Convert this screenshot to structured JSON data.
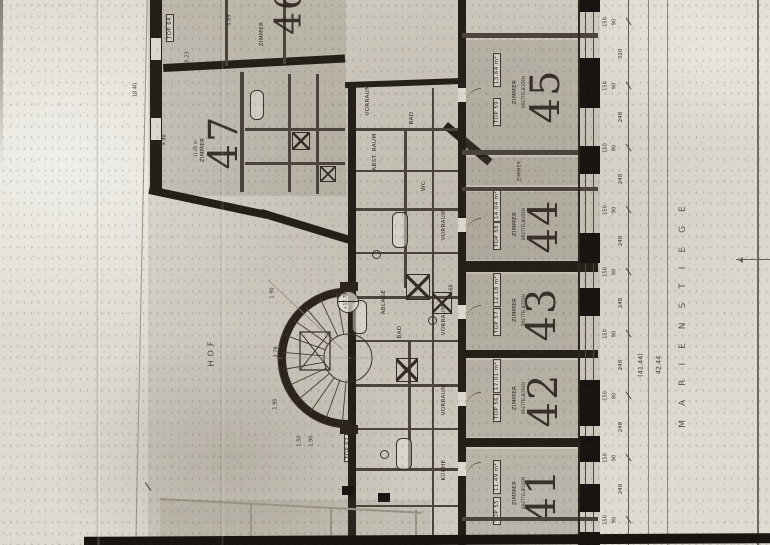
{
  "plan": {
    "street_label": "MARIENSTIEGE",
    "courtyard_label": "HOF",
    "elevation_mark": "+17.73",
    "zimmer": "ZIMMER",
    "apartments": [
      {
        "number": "45",
        "top": "TOP 59",
        "room": "ZIMMER",
        "floor": "BRETTELBODEN",
        "area": "13.64 m²"
      },
      {
        "number": "44",
        "top": "TOP 58",
        "room": "ZIMMER",
        "floor": "BRETTELBODEN",
        "area": "14.04 m²"
      },
      {
        "number": "43",
        "top": "TOP 57",
        "room": "ZIMMER",
        "floor": "BRETTELBODEN",
        "area": "12.18 m²"
      },
      {
        "number": "42",
        "top": "TOP 56",
        "room": "ZIMMER",
        "floor": "BRETTELBODEN",
        "area": "17.01 m²"
      },
      {
        "number": "41",
        "top": "TOP 55",
        "room": "ZIMMER",
        "floor": "BRETTELBODEN",
        "area": "11.49 m²"
      }
    ],
    "left_wing": {
      "room46": {
        "number": "46",
        "room": "ZIMMER"
      },
      "room47": {
        "number": "47",
        "room": "ZIMMER",
        "area": "11.85 m²"
      },
      "top64": "TOP 64",
      "top62": "TOP 62"
    },
    "corridor_labels": [
      "VORRAUM",
      "BAD",
      "WC",
      "ABLAGE",
      "ABST. RAUM",
      "KÜCHE"
    ],
    "dims": {
      "hof_length": "18.40",
      "stair": [
        "3.78",
        "1.90",
        "1.95"
      ],
      "wing": [
        "5.89",
        "5.23",
        "9.98"
      ],
      "misc": [
        "4.68",
        "1.50",
        "1.90"
      ]
    },
    "chain": {
      "window": "150",
      "pier": "90",
      "segments": [
        "320",
        "248",
        "248",
        "248",
        "248",
        "248",
        "248",
        "248"
      ],
      "totals": [
        "(41.44)",
        "42.44"
      ]
    }
  }
}
